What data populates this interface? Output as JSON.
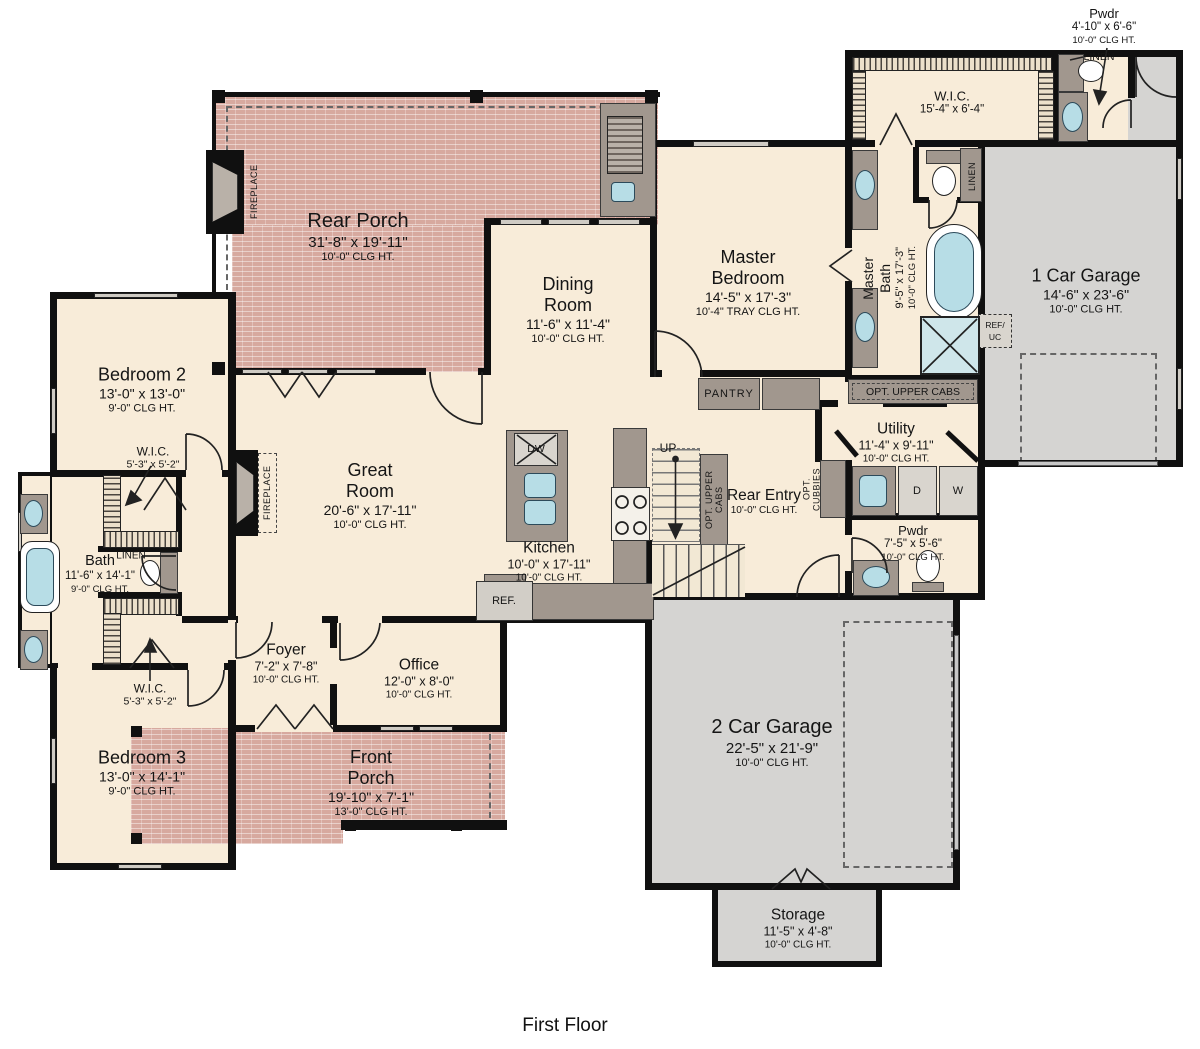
{
  "caption": "First Floor",
  "colors": {
    "porch": "#d7a99f",
    "garage": "#d5d4d2",
    "floor": "#f8ecd9",
    "wall": "#111111",
    "cabinet": "#a1978e",
    "water_fixture": "#b7dde6"
  },
  "rooms": {
    "rear_porch": {
      "name": "Rear Porch",
      "dims": "31'-8\" x 19'-11\"",
      "clg": "10'-0\" CLG HT."
    },
    "dining_room": {
      "name": "Dining Room",
      "dims": "11'-6\" x 11'-4\"",
      "clg": "10'-0\" CLG HT."
    },
    "master_bedroom": {
      "name": "Master Bedroom",
      "dims": "14'-5\" x 17'-3\"",
      "clg": "10'-4\" TRAY CLG HT."
    },
    "master_bath": {
      "name_lines": [
        "Master",
        "Bath"
      ],
      "dims": "9'-5\" x 17'-3\"",
      "clg": "10'-0\" CLG HT."
    },
    "master_wic": {
      "name": "W.I.C.",
      "dims": "15'-4\" x 6'-4\""
    },
    "pwdr_upper": {
      "name": "Pwdr",
      "dims": "4'-10\" x 6'-6\"",
      "clg": "10'-0\" CLG HT."
    },
    "garage_1car": {
      "name": "1 Car Garage",
      "dims": "14'-6\" x 23'-6\"",
      "clg": "10'-0\" CLG HT."
    },
    "bedroom2": {
      "name": "Bedroom 2",
      "dims": "13'-0\" x 13'-0\"",
      "clg": "9'-0\" CLG HT."
    },
    "wic_bedroom2": {
      "name": "W.I.C.",
      "dims": "5'-3\" x 5'-2\""
    },
    "great_room": {
      "name": "Great Room",
      "dims": "20'-6\" x 17'-11\"",
      "clg": "10'-0\" CLG HT."
    },
    "kitchen": {
      "name": "Kitchen",
      "dims": "10'-0\" x 17'-11\"",
      "clg": "10'-0\" CLG HT."
    },
    "utility": {
      "name": "Utility",
      "dims": "11'-4\" x 9'-11\"",
      "clg": "10'-0\" CLG HT."
    },
    "rear_entry": {
      "name": "Rear Entry",
      "clg": "10'-0\" CLG HT."
    },
    "pwdr_rear": {
      "name": "Pwdr",
      "dims": "7'-5\" x 5'-6\"",
      "clg": "10'-0\" CLG HT."
    },
    "bath": {
      "name": "Bath",
      "dims": "11'-6\" x 14'-1\"",
      "clg": "9'-0\" CLG HT."
    },
    "foyer": {
      "name": "Foyer",
      "dims": "7'-2\" x 7'-8\"",
      "clg": "10'-0\" CLG HT."
    },
    "office": {
      "name": "Office",
      "dims": "12'-0\" x 8'-0\"",
      "clg": "10'-0\" CLG HT."
    },
    "wic_bedroom3": {
      "name": "W.I.C.",
      "dims": "5'-3\" x 5'-2\""
    },
    "bedroom3": {
      "name": "Bedroom 3",
      "dims": "13'-0\" x 14'-1\"",
      "clg": "9'-0\" CLG HT."
    },
    "front_porch": {
      "name": "Front Porch",
      "dims": "19'-10\" x 7'-1\"",
      "clg": "13'-0\" CLG HT."
    },
    "garage_2car": {
      "name": "2 Car Garage",
      "dims": "22'-5\" x 21'-9\"",
      "clg": "10'-0\" CLG HT."
    },
    "storage": {
      "name": "Storage",
      "dims": "11'-5\" x 4'-8\"",
      "clg": "10'-0\" CLG HT."
    }
  },
  "labels": {
    "pantry": "PANTRY",
    "opt_upper_cabs": "OPT. UPPER CABS",
    "opt_cubbies": "OPT. CUBBIES",
    "linen": "LINEN",
    "fireplace": "FIREPLACE",
    "ref": "REF.",
    "ref_uc1": "REF/",
    "ref_uc2": "UC",
    "dw": "DW",
    "dryer": "D",
    "washer": "W",
    "up": "UP"
  }
}
